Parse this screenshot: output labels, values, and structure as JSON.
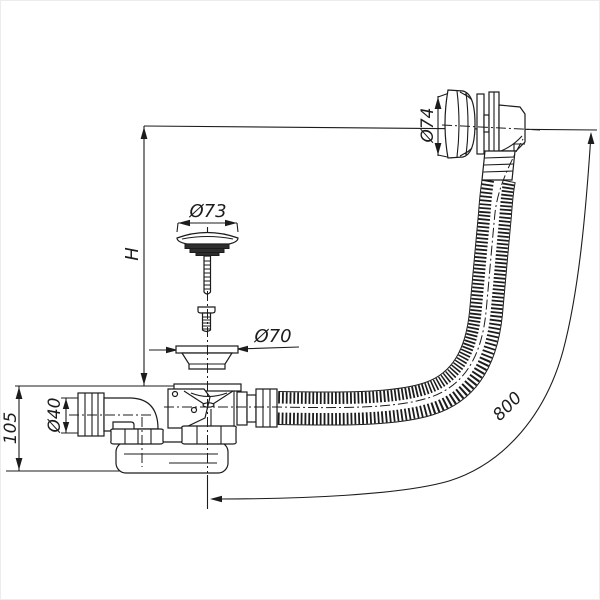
{
  "drawing": {
    "background": "#ffffff",
    "line_color": "#1c1c1c",
    "dimensions": {
      "overflow_diameter": "Ø74",
      "plug_diameter": "Ø73",
      "strainer_diameter": "Ø70",
      "outlet_diameter": "Ø40",
      "height": "H",
      "trap_height": "105",
      "hose_length": "800"
    }
  }
}
